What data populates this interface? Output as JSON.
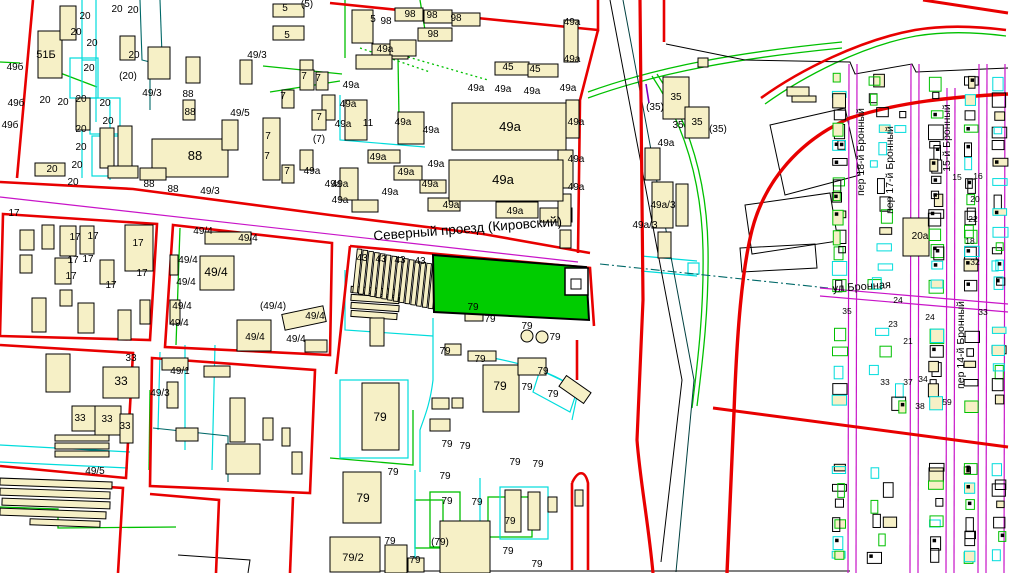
{
  "map": {
    "title": "cadastral-map-view",
    "colors": {
      "background": "#ffffff",
      "block_boundary_red": "#e80000",
      "parcel_cyan": "#00dcdc",
      "vegetation_green": "#00c000",
      "street_axis_magenta": "#c814c8",
      "rail_teal": "#006868",
      "building_fill": "#f6f0c6",
      "highlight_parcel_green": "#00cc00",
      "label_color": "#000000",
      "violet": "#8000c0"
    },
    "street_labels": [
      {
        "text": "Северный проезд (Кировский)",
        "x": 468,
        "y": 233,
        "rotate": -4.5,
        "size": 13.5
      },
      {
        "text": "ул Бронная",
        "x": 862,
        "y": 290,
        "rotate": -4,
        "size": 11
      },
      {
        "text": "пер 18-й Бронный",
        "x": 864,
        "y": 152,
        "rotate": -90,
        "size": 10.5
      },
      {
        "text": "пер 17-й Бронный",
        "x": 893,
        "y": 170,
        "rotate": -90,
        "size": 10.5
      },
      {
        "text": "15-й Бронный",
        "x": 950,
        "y": 138,
        "rotate": -90,
        "size": 10.5
      },
      {
        "text": "пер 14-й Бронный",
        "x": 964,
        "y": 345,
        "rotate": -90,
        "size": 10.5
      }
    ],
    "building_labels": [
      [
        "51Б",
        46,
        58,
        11
      ],
      [
        "49б",
        15,
        70
      ],
      [
        "49б",
        16,
        106
      ],
      [
        "49б",
        10,
        128
      ],
      [
        "20",
        117,
        12
      ],
      [
        "20",
        133,
        13
      ],
      [
        "20",
        85,
        19
      ],
      [
        "20",
        76,
        35
      ],
      [
        "20",
        92,
        46
      ],
      [
        "20",
        134,
        58
      ],
      [
        "20",
        89,
        71
      ],
      [
        "(20)",
        128,
        79
      ],
      [
        "20",
        45,
        103
      ],
      [
        "20",
        63,
        105
      ],
      [
        "20",
        81,
        102
      ],
      [
        "20",
        105,
        106
      ],
      [
        "20",
        108,
        124
      ],
      [
        "20",
        81,
        132
      ],
      [
        "20",
        81,
        150
      ],
      [
        "20",
        77,
        168
      ],
      [
        "20",
        52,
        172
      ],
      [
        "20",
        73,
        185
      ],
      [
        "49/3",
        152,
        96
      ],
      [
        "49/3",
        257,
        58
      ],
      [
        "49/3",
        210,
        194
      ],
      [
        "88",
        188,
        97
      ],
      [
        "88",
        190,
        115
      ],
      [
        "88",
        195,
        160,
        13
      ],
      [
        "88",
        149,
        187
      ],
      [
        "88",
        173,
        192
      ],
      [
        "49/5",
        240,
        116
      ],
      [
        "5",
        285,
        11
      ],
      [
        "(5)",
        307,
        7
      ],
      [
        "5",
        287,
        38
      ],
      [
        "5",
        373,
        22
      ],
      [
        "98",
        386,
        24
      ],
      [
        "98",
        410,
        17
      ],
      [
        "98",
        432,
        18
      ],
      [
        "98",
        456,
        21
      ],
      [
        "98",
        433,
        37
      ],
      [
        "7",
        304,
        79
      ],
      [
        "7",
        318,
        81
      ],
      [
        "7",
        283,
        99
      ],
      [
        "7",
        319,
        120
      ],
      [
        "(7)",
        319,
        142
      ],
      [
        "7",
        268,
        139
      ],
      [
        "7",
        267,
        159
      ],
      [
        "7",
        287,
        174
      ],
      [
        "45",
        508,
        70
      ],
      [
        "45",
        535,
        72
      ],
      [
        "11",
        368,
        126
      ],
      [
        "49а",
        351,
        88
      ],
      [
        "49а",
        385,
        52
      ],
      [
        "49а",
        476,
        91
      ],
      [
        "49а",
        503,
        92
      ],
      [
        "49а",
        532,
        94
      ],
      [
        "49а",
        572,
        25
      ],
      [
        "49а",
        572,
        62
      ],
      [
        "49а",
        568,
        91
      ],
      [
        "49а",
        348,
        107
      ],
      [
        "49а",
        343,
        127
      ],
      [
        "49а",
        403,
        125
      ],
      [
        "49а",
        431,
        133
      ],
      [
        "49а",
        510,
        131,
        13
      ],
      [
        "49а",
        378,
        160
      ],
      [
        "49а",
        406,
        175
      ],
      [
        "49а",
        436,
        167
      ],
      [
        "49а",
        430,
        187
      ],
      [
        "49а",
        390,
        195
      ],
      [
        "49а",
        340,
        187
      ],
      [
        "49а",
        340,
        203
      ],
      [
        "49а",
        503,
        184,
        13
      ],
      [
        "49а",
        576,
        162
      ],
      [
        "49а",
        576,
        190
      ],
      [
        "49а",
        451,
        208
      ],
      [
        "49а",
        515,
        214
      ],
      [
        "49а",
        576,
        125
      ],
      [
        "49а",
        312,
        174
      ],
      [
        "49а",
        333,
        187
      ],
      [
        "49а",
        666,
        146
      ],
      [
        "35",
        676,
        100
      ],
      [
        "35",
        697,
        125
      ],
      [
        "35",
        678,
        128
      ],
      [
        "(35)",
        718,
        132
      ],
      [
        "(35)",
        655,
        110
      ],
      [
        "49а/3",
        663,
        208
      ],
      [
        "49а/3",
        645,
        228
      ],
      [
        "17",
        14,
        216
      ],
      [
        "17",
        75,
        240
      ],
      [
        "17",
        93,
        239
      ],
      [
        "17",
        138,
        246
      ],
      [
        "17",
        73,
        263
      ],
      [
        "17",
        88,
        262
      ],
      [
        "17",
        71,
        279
      ],
      [
        "17",
        111,
        288
      ],
      [
        "17",
        142,
        276
      ],
      [
        "49/4",
        203,
        234
      ],
      [
        "49/4",
        248,
        241
      ],
      [
        "49/4",
        188,
        263
      ],
      [
        "49/4",
        186,
        285
      ],
      [
        "49/4",
        216,
        276,
        12
      ],
      [
        "49/4",
        182,
        309
      ],
      [
        "49/4",
        179,
        326
      ],
      [
        "49/4",
        255,
        340
      ],
      [
        "(49/4)",
        273,
        309
      ],
      [
        "49/4",
        315,
        319
      ],
      [
        "49/4",
        296,
        342
      ],
      [
        "33",
        131,
        361
      ],
      [
        "33",
        121,
        385,
        12
      ],
      [
        "33",
        80,
        421
      ],
      [
        "33",
        107,
        422
      ],
      [
        "33",
        125,
        429
      ],
      [
        "49/1",
        180,
        374
      ],
      [
        "49/3",
        160,
        396
      ],
      [
        "49/5",
        95,
        474
      ],
      [
        "43",
        362,
        261
      ],
      [
        "43",
        381,
        262
      ],
      [
        "43",
        400,
        263
      ],
      [
        "43",
        420,
        264
      ],
      [
        "79",
        473,
        310
      ],
      [
        "79",
        490,
        322
      ],
      [
        "79",
        527,
        329
      ],
      [
        "79",
        555,
        340
      ],
      [
        "79",
        380,
        421,
        12
      ],
      [
        "79",
        445,
        354
      ],
      [
        "79",
        480,
        362
      ],
      [
        "79",
        500,
        390,
        12
      ],
      [
        "79",
        543,
        374
      ],
      [
        "79",
        527,
        390
      ],
      [
        "79",
        553,
        397
      ],
      [
        "79",
        447,
        447
      ],
      [
        "79",
        465,
        449
      ],
      [
        "79",
        515,
        465
      ],
      [
        "79",
        538,
        467
      ],
      [
        "79",
        393,
        475
      ],
      [
        "79",
        445,
        479
      ],
      [
        "79",
        363,
        502,
        12
      ],
      [
        "79",
        447,
        504
      ],
      [
        "79",
        477,
        505
      ],
      [
        "79",
        510,
        524
      ],
      [
        "(79)",
        440,
        545
      ],
      [
        "79",
        390,
        544
      ],
      [
        "79",
        415,
        563
      ],
      [
        "79",
        508,
        554
      ],
      [
        "79",
        537,
        567
      ],
      [
        "79/2",
        353,
        561,
        11
      ],
      [
        "20а",
        920,
        239
      ],
      [
        "15",
        957,
        180,
        8.5
      ],
      [
        "16",
        978,
        179,
        8.5
      ],
      [
        "20",
        975,
        202,
        8.5
      ],
      [
        "22",
        973,
        222,
        8.5
      ],
      [
        "18",
        970,
        244,
        8.5
      ],
      [
        "32",
        975,
        265,
        8.5
      ],
      [
        "35",
        847,
        314,
        8.5
      ],
      [
        "24",
        898,
        303,
        8.5
      ],
      [
        "24",
        930,
        320,
        8.5
      ],
      [
        "23",
        893,
        327,
        8.5
      ],
      [
        "21",
        908,
        344,
        8.5
      ],
      [
        "34",
        923,
        382,
        8.5
      ],
      [
        "37",
        908,
        385,
        8.5
      ],
      [
        "38",
        920,
        409,
        8.5
      ],
      [
        "33",
        885,
        385,
        8.5
      ],
      [
        "59",
        947,
        405,
        8.5
      ],
      [
        "33",
        983,
        315,
        8.5
      ]
    ],
    "highlighted_parcel": {
      "name": "selected-parcel",
      "fill": "#00cc00"
    }
  }
}
